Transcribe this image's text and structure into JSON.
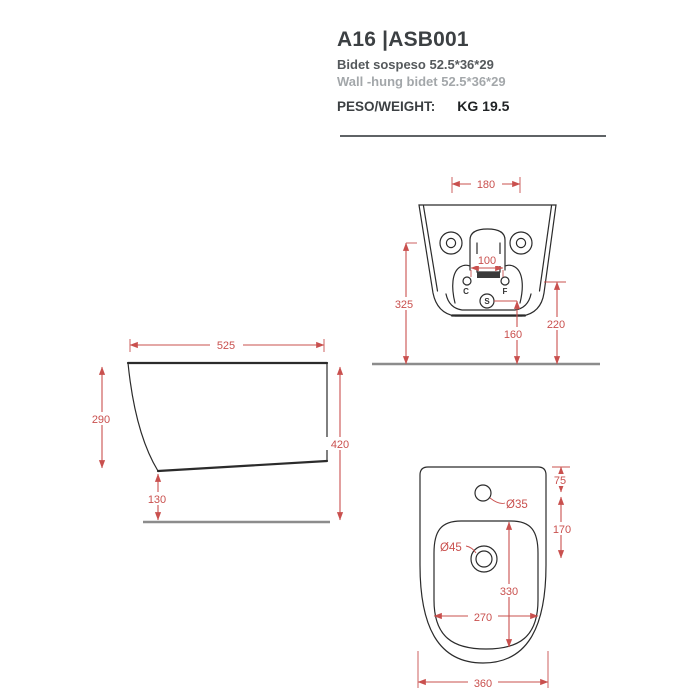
{
  "header": {
    "title": "A16 |ASB001",
    "subtitle_it": "Bidet sospeso 52.5*36*29",
    "subtitle_en": "Wall -hung bidet 52.5*36*29",
    "weight_label": "PESO/WEIGHT:",
    "weight_value": "KG 19.5"
  },
  "colors": {
    "dim": "#c9504e",
    "line": "#2b2b2b",
    "floor": "#8c8c8c",
    "title": "#3c4043",
    "sub": "#55595c",
    "sub2": "#a3a7aa",
    "div": "#5f6366"
  },
  "views": {
    "rear": {
      "dims": {
        "mount_width": "180",
        "inlet_spacing": "100",
        "height_left": "325",
        "height_right": "220",
        "drain_height": "160"
      },
      "labels": {
        "cold": "C",
        "hot": "F",
        "drain": "S"
      }
    },
    "side": {
      "dims": {
        "depth": "525",
        "front_height": "290",
        "overall_height": "420",
        "bottom_clearance": "130"
      }
    },
    "top": {
      "dims": {
        "tap_offset": "75",
        "tap_to_drain": "170",
        "tap_hole_dia": "Ø35",
        "drain_dia": "Ø45",
        "basin_length": "330",
        "basin_width": "270",
        "overall_width": "360"
      }
    }
  }
}
